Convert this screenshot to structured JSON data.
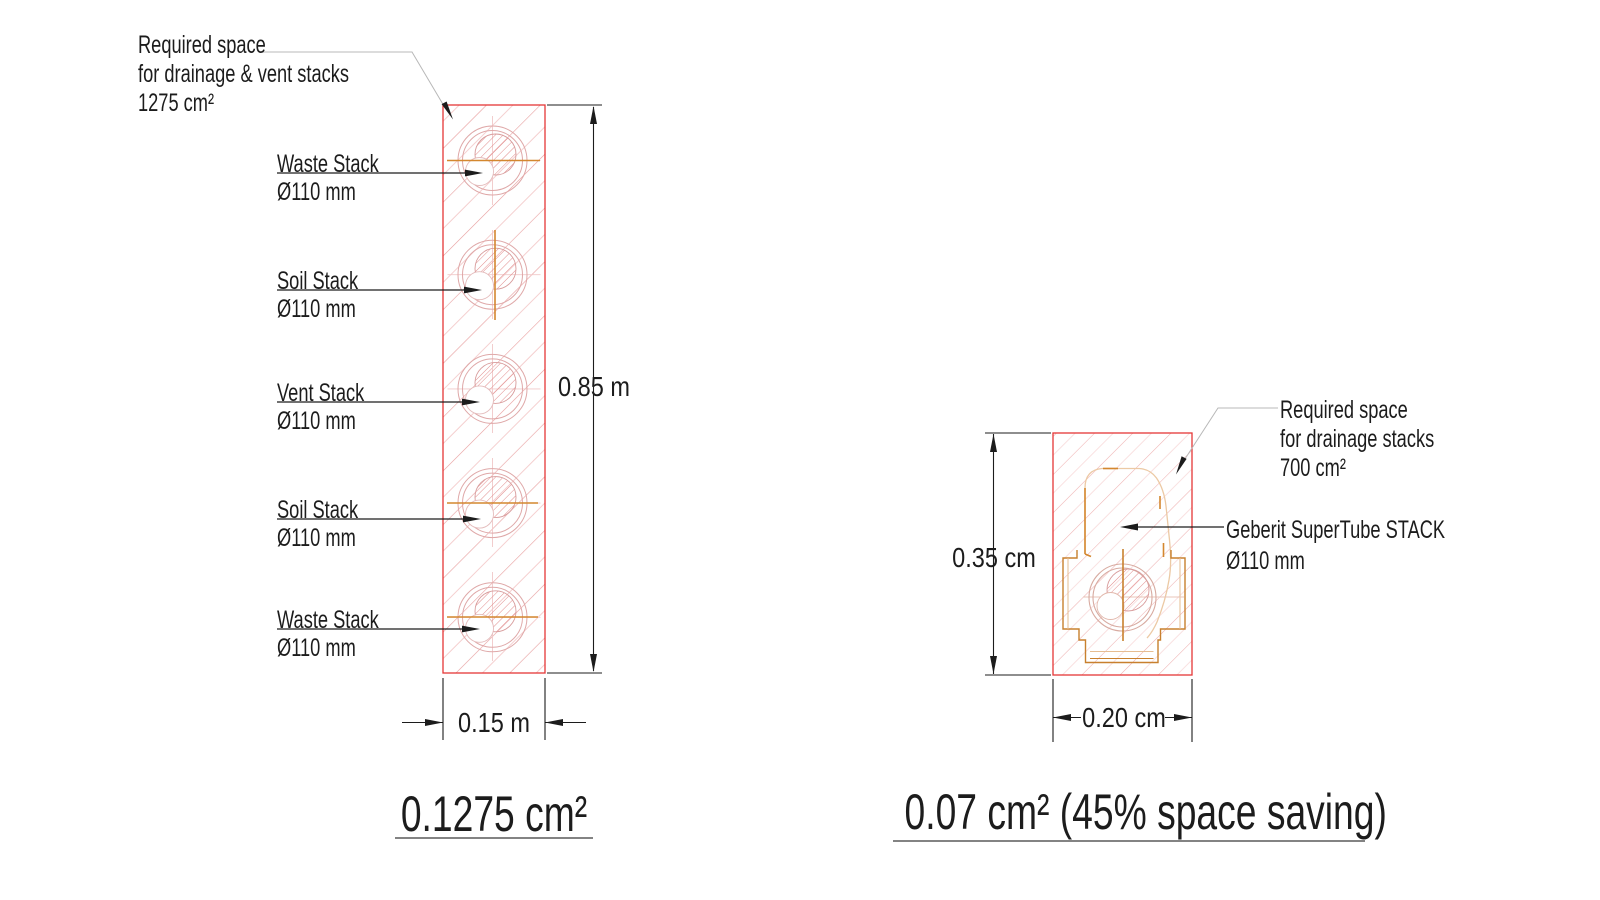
{
  "left_diagram": {
    "annotation": {
      "line1": "Required space",
      "line2": "for drainage & vent stacks",
      "line3": "1275 cm²"
    },
    "labels": [
      {
        "name": "Waste Stack",
        "size": "Ø110 mm"
      },
      {
        "name": "Soil Stack",
        "size": "Ø110 mm"
      },
      {
        "name": "Vent Stack",
        "size": "Ø110 mm"
      },
      {
        "name": "Soil Stack",
        "size": "Ø110 mm"
      },
      {
        "name": "Waste Stack",
        "size": "Ø110 mm"
      }
    ],
    "height_dim": "0.85 m",
    "width_dim": "0.15 m",
    "caption": "0.1275 cm²"
  },
  "right_diagram": {
    "annotation": {
      "line1": "Required space",
      "line2": "for drainage stacks",
      "line3": "700 cm²"
    },
    "product_label": {
      "line1": "Geberit SuperTube STACK",
      "line2": "Ø110 mm"
    },
    "height_dim": "0.35 cm",
    "width_dim": "0.20 cm",
    "caption": "0.07 cm² (45% space saving)"
  },
  "colors": {
    "outline_red": "#e43737",
    "hatch_pink": "#e79d9d",
    "fitting_orange": "#c8802e",
    "dimension_black": "#1c1c1c",
    "leader_grey": "#b8b8b8"
  }
}
